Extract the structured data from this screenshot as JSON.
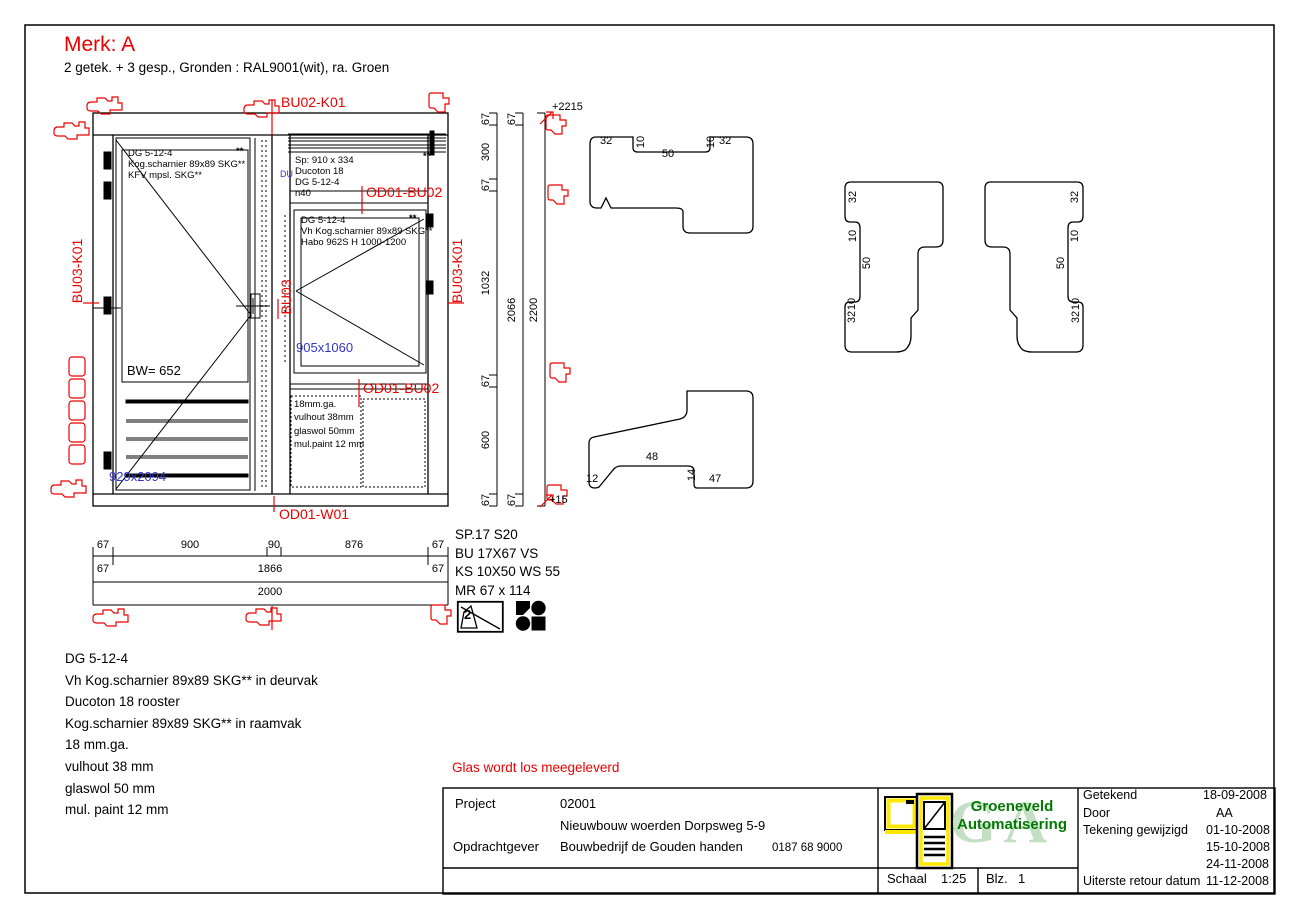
{
  "colors": {
    "red": "#ec0000",
    "blue": "#3535cc",
    "green": "#007a00",
    "light_green": "#c4dfc4",
    "yellow": "#ffe800"
  },
  "header": {
    "mark": "Merk:  A",
    "subtitle": "2 getek. + 3 gesp., Gronden : RAL9001(wit), ra. Groen"
  },
  "red_labels": {
    "top": "BU02-K01",
    "od01_bu02_a": "OD01-BU02",
    "od01_bu02_b": "OD01-BU02",
    "bottom": "OD01-W01",
    "left": "BU03-K01",
    "right": "BU03-K01",
    "center": "BU03"
  },
  "elevation": {
    "door_note": [
      "DG 5-12-4",
      "Kog.scharnier 89x89 SKG**",
      "KFV mpsl. SKG**"
    ],
    "rooster_note": [
      "Sp: 910 x 334",
      "Ducoton 18",
      "DG 5-12-4",
      "n40"
    ],
    "window_note": [
      "DG 5-12-4",
      "Vh Kog.scharnier 89x89 SKG**",
      "Habo 962S H 1000-1200"
    ],
    "panel_note": [
      "18mm.ga.",
      "vulhout 38mm",
      "glaswol 50mm",
      "mul.paint 12 mm"
    ],
    "corner_stars": "**",
    "bw": "BW= 652",
    "door_size": "929x2094",
    "window_size": "905x1060",
    "blue_marker": "DU"
  },
  "dimensions": {
    "bottom_row1": [
      "67",
      "900",
      "90",
      "876",
      "67"
    ],
    "bottom_row2": [
      "67",
      "1866",
      "67"
    ],
    "bottom_total": "2000",
    "right_col1": [
      "67",
      "300",
      "67",
      "1032",
      "67",
      "600",
      "67"
    ],
    "right_col2": [
      "67",
      "2066",
      "67"
    ],
    "right_total": "2200",
    "level_top": "+2215",
    "level_bottom": "+15"
  },
  "profiles": {
    "top_dims": [
      "32",
      "10",
      "50",
      "10",
      "32"
    ],
    "left_stile_dims": [
      "32",
      "10",
      "50",
      "10",
      "32"
    ],
    "right_stile_dims": [
      "32",
      "10",
      "50",
      "10",
      "32"
    ],
    "bottom_dims": [
      "12",
      "48",
      "14",
      "47"
    ]
  },
  "spec_block": {
    "lines": [
      "SP.17 S20",
      "BU 17X67 VS",
      "KS 10X50 WS 55",
      "MR 67 x 114"
    ],
    "glass_icon_number": "2"
  },
  "materials": [
    "DG 5-12-4",
    "Vh Kog.scharnier 89x89 SKG** in deurvak",
    "Ducoton 18 rooster",
    "Kog.scharnier 89x89 SKG** in raamvak",
    "18 mm.ga.",
    "vulhout 38 mm",
    "glaswol 50 mm",
    "mul. paint 12 mm"
  ],
  "glass_note": "Glas wordt los meegeleverd",
  "title_block": {
    "project_label": "Project",
    "project_number": "02001",
    "project_name": "Nieuwbouw woerden Dorpsweg 5-9",
    "client_label": "Opdrachtgever",
    "client_name": "Bouwbedrijf de Gouden handen",
    "client_phone": "0187 68 9000",
    "schaal_label": "Schaal",
    "schaal_value": "1:25",
    "blz_label": "Blz.",
    "blz_value": "1",
    "company_line1": "Groeneveld",
    "company_line2": "Automatisering",
    "company_monogram": "GA",
    "rows": {
      "getekend_label": "Getekend",
      "getekend_value": "18-09-2008",
      "door_label": "Door",
      "door_value": "AA",
      "gewijzigd_label": "Tekening gewijzigd",
      "gewijzigd_dates": [
        "01-10-2008",
        "15-10-2008",
        "24-11-2008"
      ],
      "retour_label": "Uiterste retour datum",
      "retour_value": "11-12-2008"
    }
  }
}
